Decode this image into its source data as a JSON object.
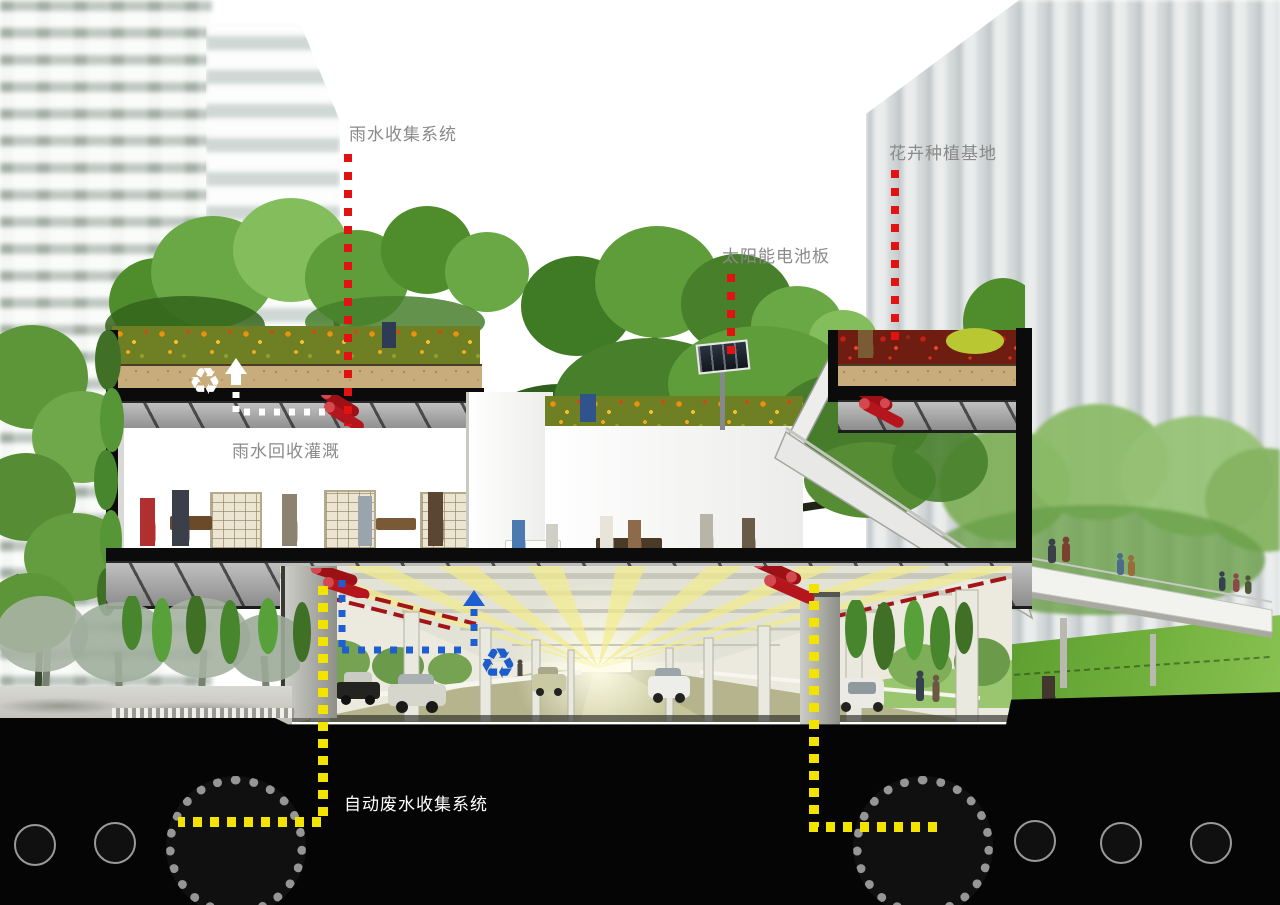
{
  "annotations": {
    "rainwater_collection": "雨水收集系统",
    "flower_planting_base": "花卉种植基地",
    "solar_panel": "太阳能电池板",
    "rainwater_irrigation": "雨水回收灌溉",
    "wastewater_system": "自动废水收集系统"
  },
  "icons": {
    "recycle": "♻",
    "up_arrow": "dotted-up-arrow",
    "leader_line": "red-dotted-leader"
  },
  "colors": {
    "leader_red": "#e11212",
    "flow_yellow": "#f3e400",
    "flow_blue": "#1f5ed1",
    "flow_white": "#ffffff",
    "label_gray": "#8a8a8a",
    "label_white": "#ffffff",
    "underground_black": "#050505",
    "grass_green": "#6fae3a",
    "soil_tan": "#c9ac7c",
    "pipe_red": "#9c1016",
    "road_khaki": "#b5b48c"
  }
}
